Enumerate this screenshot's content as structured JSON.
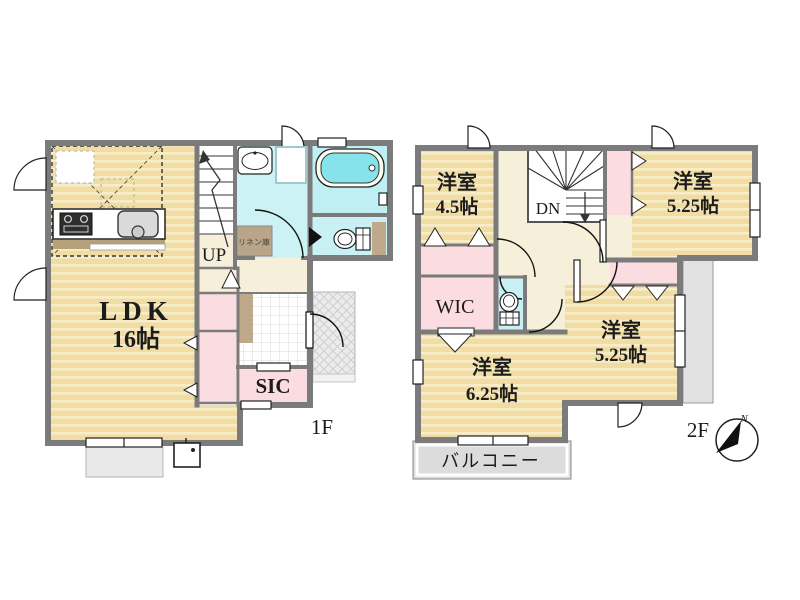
{
  "floor1": {
    "floor_label": "1F",
    "ldk_name": "LDK",
    "ldk_size": "16帖",
    "stairs_label": "UP",
    "linen_closet_label": "リネン庫",
    "shoe_closet_label": "SIC"
  },
  "floor2": {
    "floor_label": "2F",
    "stairs_label": "DN",
    "wic_label": "WIC",
    "balcony_label": "バルコニー",
    "rooms": [
      {
        "name": "洋室",
        "size": "4.5帖"
      },
      {
        "name": "洋室",
        "size": "5.25帖"
      },
      {
        "name": "洋室",
        "size": "5.25帖"
      },
      {
        "name": "洋室",
        "size": "6.25帖"
      }
    ]
  },
  "compass": {
    "north_label": "N"
  },
  "colors": {
    "wall": "#7b7b7b",
    "wood_floor": "#f1dca3",
    "wood_floor_stripe": "#f8edc9",
    "closet_pink": "#fbdce0",
    "wet_area_cyan": "#c9f0f4",
    "bathtub_cyan": "#86e3ea",
    "hall_cream": "#f6efda",
    "wood_trim_brown": "#bfa98b",
    "balcony_gray": "#dcdcdc"
  }
}
